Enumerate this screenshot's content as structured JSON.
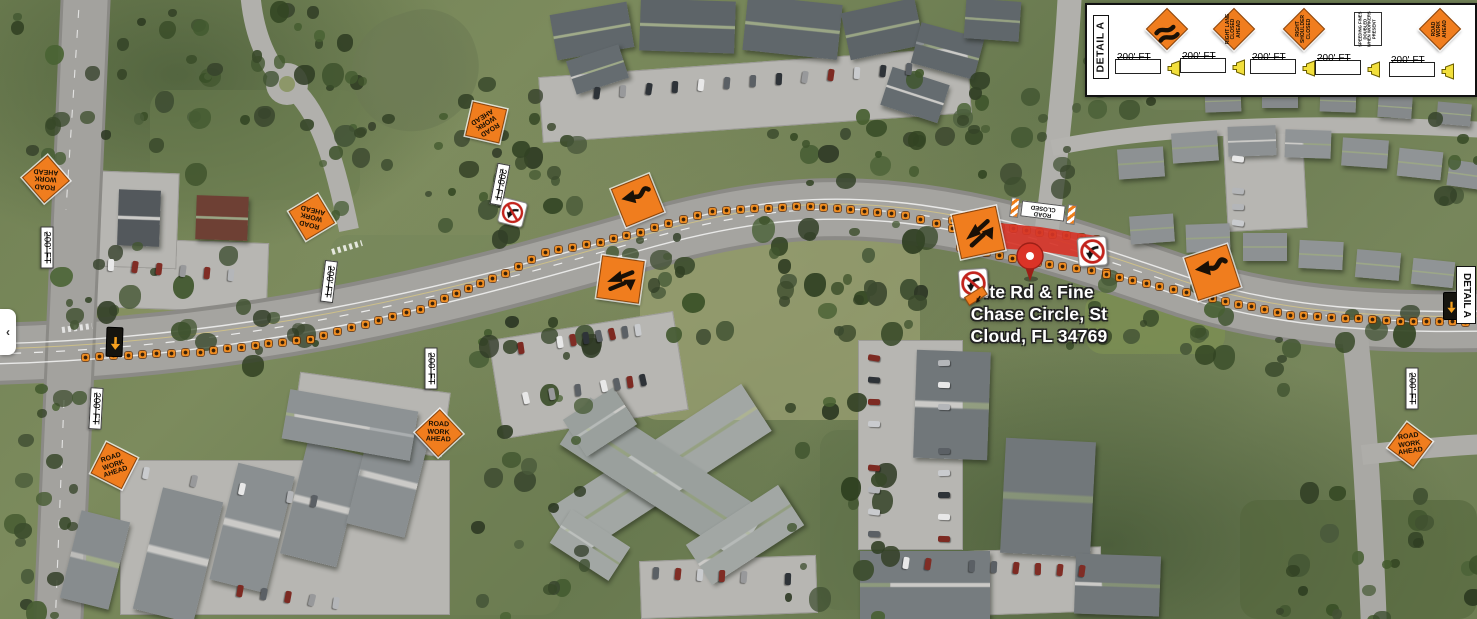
{
  "map": {
    "place_label": {
      "lines": [
        "lte Rd & Fine",
        "Chase Circle, St",
        "Cloud, FL 34769"
      ]
    },
    "pin": {
      "x": 1030,
      "y": 256
    },
    "work_zone_color": "#D63428",
    "signs": [
      {
        "id": "rwa-1",
        "type": "diamond-text",
        "name": "road-work-ahead-sign",
        "lines": [
          "ROAD",
          "WORK",
          "AHEAD"
        ],
        "x": 45,
        "y": 178,
        "size": 47,
        "rot": 4,
        "text_rot": 180
      },
      {
        "id": "rwa-2",
        "type": "diamond-text",
        "name": "road-work-ahead-sign",
        "lines": [
          "ROAD",
          "WORK",
          "AHEAD"
        ],
        "x": 311,
        "y": 216,
        "size": 47,
        "rot": 14,
        "text_rot": 180
      },
      {
        "id": "rwa-3",
        "type": "diamond-text",
        "name": "road-work-ahead-sign",
        "lines": [
          "ROAD",
          "WORK",
          "AHEAD"
        ],
        "x": 485,
        "y": 122,
        "size": 49,
        "rot": -32,
        "text_rot": 180
      },
      {
        "id": "rwa-4",
        "type": "diamond-text",
        "name": "road-work-ahead-sign",
        "lines": [
          "ROAD",
          "WORK",
          "AHEAD"
        ],
        "x": 113,
        "y": 465,
        "size": 49,
        "rot": -18,
        "text_rot": 0
      },
      {
        "id": "rwa-5",
        "type": "diamond-text",
        "name": "road-work-ahead-sign",
        "lines": [
          "ROAD",
          "WORK",
          "AHEAD"
        ],
        "x": 438,
        "y": 432,
        "size": 47,
        "rot": 2,
        "text_rot": 0
      },
      {
        "id": "rwa-6",
        "type": "diamond-text",
        "name": "road-work-ahead-sign",
        "lines": [
          "ROAD",
          "WORK",
          "AHEAD"
        ],
        "x": 1409,
        "y": 444,
        "size": 45,
        "rot": -8,
        "text_rot": 0
      },
      {
        "id": "shift-1",
        "type": "reverse-curve-arrow",
        "name": "reverse-curve-arrow-sign",
        "x": 637,
        "y": 200,
        "size": 41,
        "rot": -22
      },
      {
        "id": "shift-2",
        "type": "double-shift-arrows",
        "name": "two-way-shift-arrows-sign",
        "x": 620,
        "y": 279,
        "size": 43,
        "rot": 8
      },
      {
        "id": "shift-3",
        "type": "double-shift-arrows",
        "name": "two-way-shift-arrows-sign",
        "x": 978,
        "y": 232,
        "size": 45,
        "rot": -12
      },
      {
        "id": "shift-4",
        "type": "reverse-curve-arrow",
        "name": "reverse-curve-arrow-sign",
        "x": 1212,
        "y": 272,
        "size": 45,
        "rot": -18
      },
      {
        "id": "noturn-1",
        "type": "no-left-turn",
        "name": "no-left-turn-sign",
        "x": 512,
        "y": 212,
        "size": 27,
        "rot": 14
      },
      {
        "id": "noturn-2",
        "type": "no-left-turn",
        "name": "no-left-turn-sign",
        "x": 973,
        "y": 283,
        "size": 31,
        "rot": -4,
        "arrow_tab": true
      },
      {
        "id": "noturn-3",
        "type": "no-left-turn",
        "name": "no-left-turn-sign",
        "x": 1092,
        "y": 251,
        "size": 31,
        "rot": -4
      },
      {
        "id": "rc-1",
        "type": "barricade",
        "name": "road-closed-barricade",
        "label": "ROAD CLOSED",
        "x": 1043,
        "y": 211,
        "w": 66,
        "h": 22,
        "rot": 187
      },
      {
        "id": "ab-1",
        "type": "arrow-board",
        "name": "flashing-arrow-board",
        "x": 114,
        "y": 342,
        "w": 17,
        "h": 30,
        "rot": 2
      },
      {
        "id": "ab-2",
        "type": "arrow-board",
        "name": "flashing-arrow-board",
        "x": 1450,
        "y": 306,
        "w": 15,
        "h": 28,
        "rot": 0
      }
    ],
    "distance_labels": [
      {
        "label": "200' FT",
        "x": 47,
        "y": 247,
        "rot": 90
      },
      {
        "label": "200' FT",
        "x": 329,
        "y": 281,
        "rot": 97
      },
      {
        "label": "200' FT",
        "x": 500,
        "y": 184,
        "rot": 101
      },
      {
        "label": "200' FT",
        "x": 431,
        "y": 368,
        "rot": 90
      },
      {
        "label": "200' FT",
        "x": 96,
        "y": 408,
        "rot": 93
      },
      {
        "label": "200' FT",
        "x": 1412,
        "y": 388,
        "rot": 90
      }
    ]
  },
  "legend": {
    "title": "DETAIL A",
    "spacing_label": "200' FT",
    "items": [
      {
        "name": "double-reverse-curve-sign",
        "type": "diamond-glyph",
        "lines": []
      },
      {
        "name": "right-lane-closed-ahead-sign",
        "type": "diamond-text",
        "lines": [
          "RIGHT LANE",
          "CLOSED",
          "AHEAD"
        ]
      },
      {
        "name": "right-shoulder-closed-sign",
        "type": "diamond-text",
        "lines": [
          "RIGHT",
          "SHOULDER",
          "CLOSED"
        ]
      },
      {
        "name": "speeding-fines-doubled-sign",
        "type": "white-rect-text",
        "lines": [
          "SPEEDING FINES",
          "DOUBLED",
          "WHEN WORKERS",
          "PRESENT"
        ]
      },
      {
        "name": "road-work-ahead-sign",
        "type": "diamond-text",
        "lines": [
          "ROAD",
          "WORK",
          "AHEAD"
        ]
      }
    ]
  },
  "detail_tab": {
    "label": "DETAIL A"
  },
  "side_panel": {
    "chevron": "‹"
  },
  "colors": {
    "work_sign_orange": "#F07D1E",
    "barrel_orange": "#EF7D1A",
    "zone_red": "#D63428",
    "pin_red": "#DB3327",
    "legend_yellow": "#F2DF3C"
  }
}
